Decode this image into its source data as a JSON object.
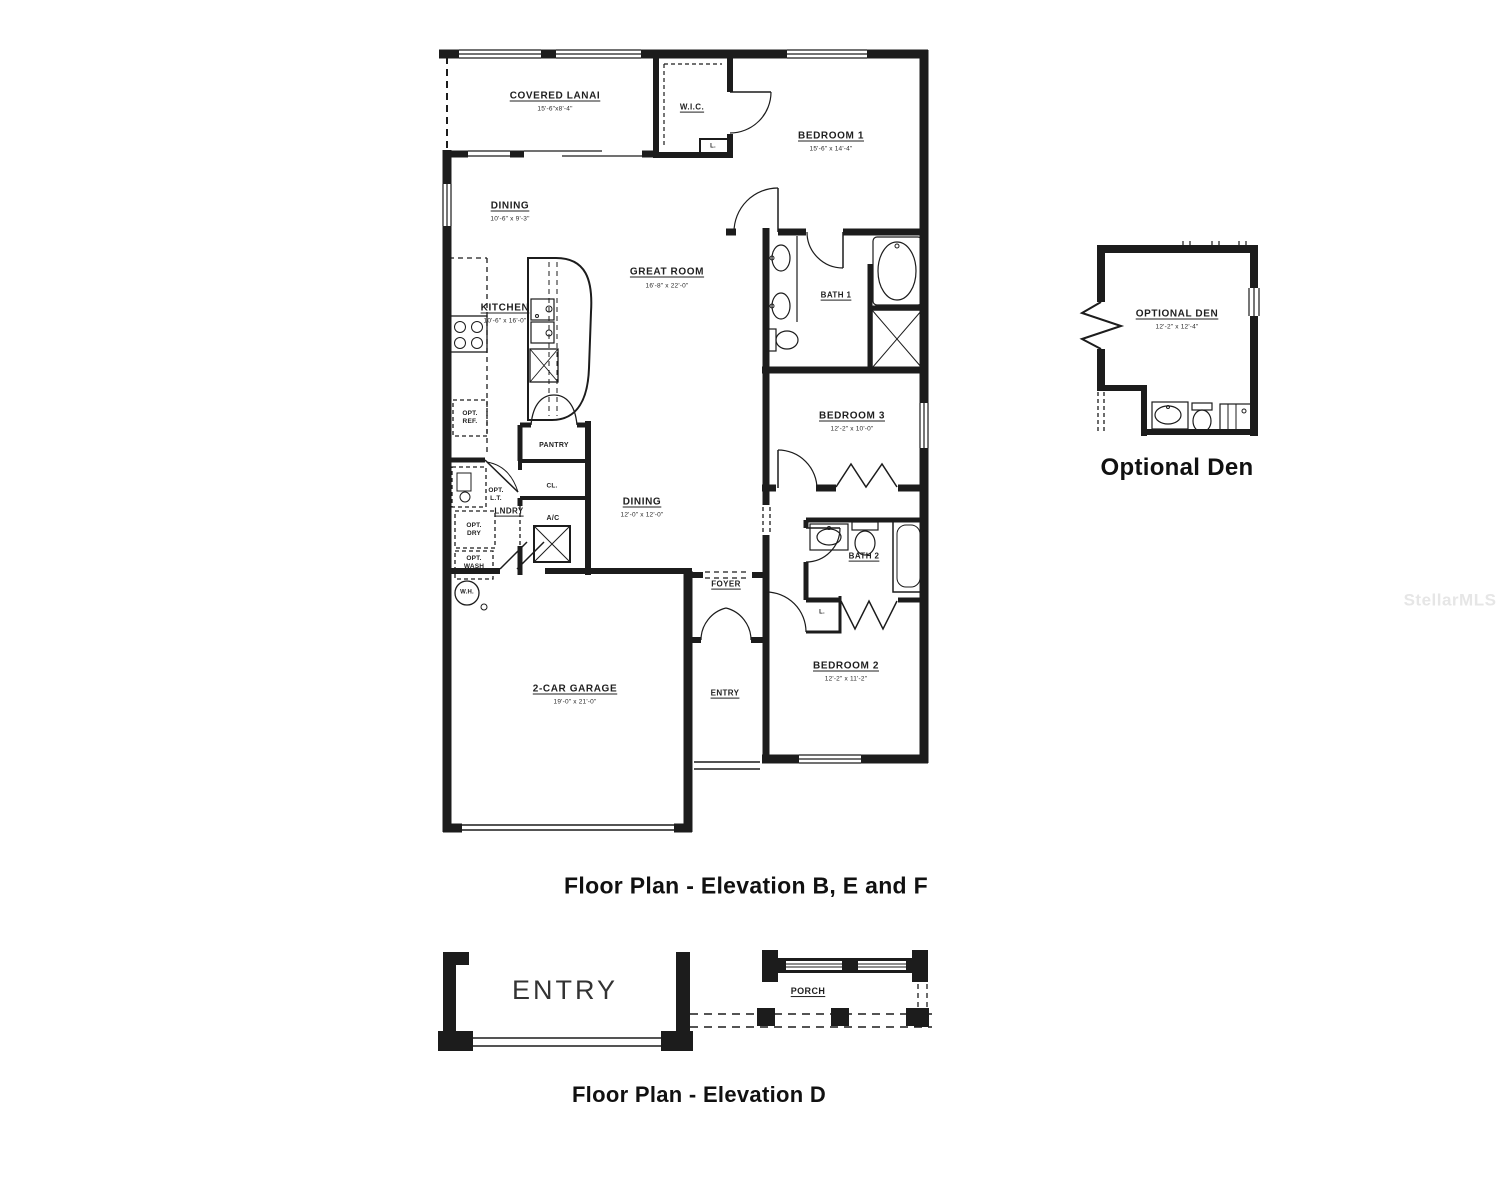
{
  "watermark": "StellarMLS",
  "main_plan": {
    "title": "Floor Plan - Elevation B, E and F",
    "rooms": {
      "covered_lanai": {
        "name": "COVERED LANAI",
        "dims": "15'-6\"x8'-4\""
      },
      "wic": {
        "name": "W.I.C."
      },
      "wic_linen": {
        "name": "L."
      },
      "bedroom1": {
        "name": "BEDROOM 1",
        "dims": "15'-6\" x 14'-4\""
      },
      "dining_front": {
        "name": "DINING",
        "dims": "10'-6\" x 9'-3\""
      },
      "great_room": {
        "name": "GREAT ROOM",
        "dims": "16'-8\" x 22'-0\""
      },
      "kitchen": {
        "name": "KITCHEN",
        "dims": "10'-6\" x 16'-0\""
      },
      "bath1": {
        "name": "BATH 1"
      },
      "bedroom3": {
        "name": "BEDROOM 3",
        "dims": "12'-2\" x 10'-0\""
      },
      "pantry": {
        "name": "PANTRY"
      },
      "closet": {
        "name": "CL."
      },
      "dining_rear": {
        "name": "DINING",
        "dims": "12'-0\" x 12'-0\""
      },
      "laundry": {
        "name": "LNDRY"
      },
      "opt_lt": {
        "name": "OPT. L.T."
      },
      "opt_dry": {
        "name": "OPT. DRY"
      },
      "opt_wash": {
        "name": "OPT. WASH"
      },
      "opt_ref": {
        "name": "OPT. REF."
      },
      "ac": {
        "name": "A/C"
      },
      "water_heater": {
        "name": "W.H."
      },
      "foyer": {
        "name": "FOYER"
      },
      "bath2": {
        "name": "BATH 2"
      },
      "linen": {
        "name": "L."
      },
      "bedroom2": {
        "name": "BEDROOM 2",
        "dims": "12'-2\" x 11'-2\""
      },
      "entry": {
        "name": "ENTRY"
      },
      "garage": {
        "name": "2-CAR GARAGE",
        "dims": "19'-0\" x 21'-0\""
      }
    }
  },
  "optional_den": {
    "title": "Optional Den",
    "room": {
      "name": "OPTIONAL DEN",
      "dims": "12'-2\" x 12'-4\""
    }
  },
  "elevation_d": {
    "title": "Floor Plan - Elevation D",
    "entry_label": "ENTRY",
    "porch_label": "PORCH"
  },
  "colors": {
    "wall": "#1c1c1c",
    "background": "#ffffff",
    "watermark": "#e6e6e6"
  }
}
